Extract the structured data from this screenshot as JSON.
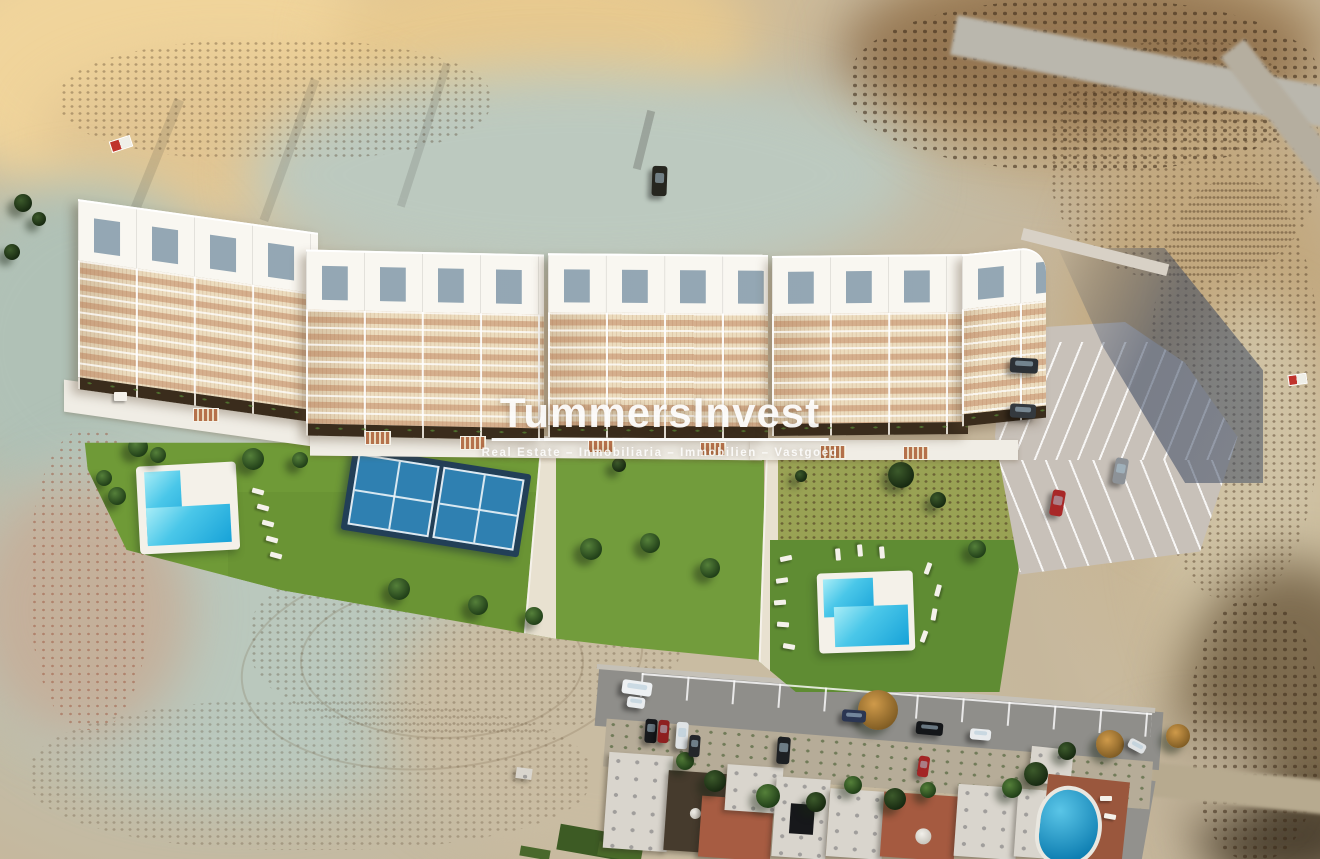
{
  "watermark": {
    "title": "TummersInvest",
    "subtitle": "Real Estate – Inmobiliaria – Immobilien – Vastgoed"
  },
  "palette": {
    "terrain_sand": "#c6b79c",
    "terrain_pale_gully": "#b4c4ba",
    "terrain_gold": "#ebcd94",
    "scrub_brown": "#7c5d3e",
    "building_white": "#f9f7f1",
    "terrace_cream": "#ecdcbe",
    "pergola_tan": "#b5714b",
    "roof_glass_gray": "#8ba0af",
    "lawn_green": "#6f9a37",
    "lawn_dark_green": "#5f8c33",
    "pool_water_blue": "#35c2e8",
    "padel_enclosure_navy": "#223f57",
    "padel_court_blue": "#2f80b1",
    "parking_gray": "#c8c1b9",
    "road_asphalt": "#8f8e8a",
    "roof_terracotta": "#a75c42",
    "roof_dark_brown": "#463b2d",
    "watermark_white": "#ffffff"
  }
}
